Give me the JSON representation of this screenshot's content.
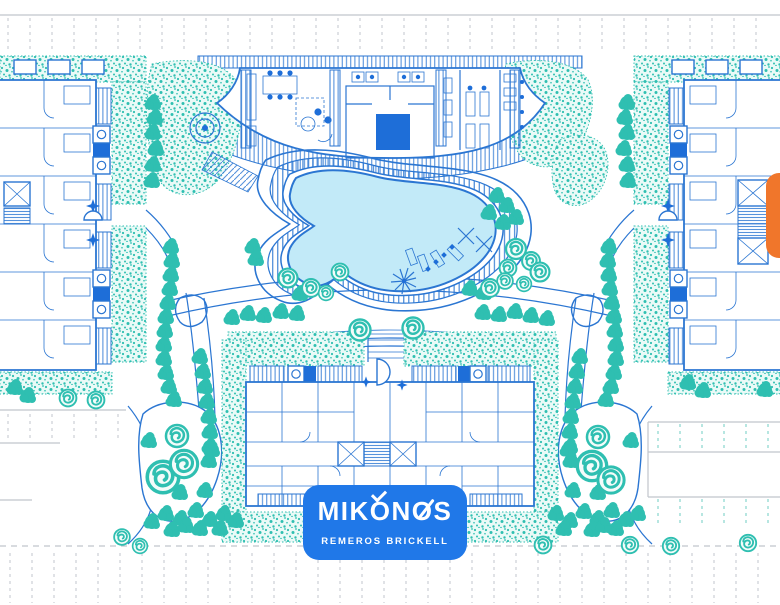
{
  "plan": {
    "type": "architectural-site-plan",
    "project_name": "MIKONOS",
    "project_tagline": "REMEROS BRICKELL"
  },
  "logo": {
    "title": "MIKONOS",
    "subtitle": "REMEROS BRICKELL"
  },
  "colors": {
    "line": "#2b76d2",
    "fill": "#1e6ed8",
    "teal": "#2fbfb1",
    "tealbg": "#eafaf7",
    "pool": "#c2eaf8",
    "gray": "#c0c5cc",
    "orange": "#f0762b",
    "logo": "#2078e8"
  }
}
